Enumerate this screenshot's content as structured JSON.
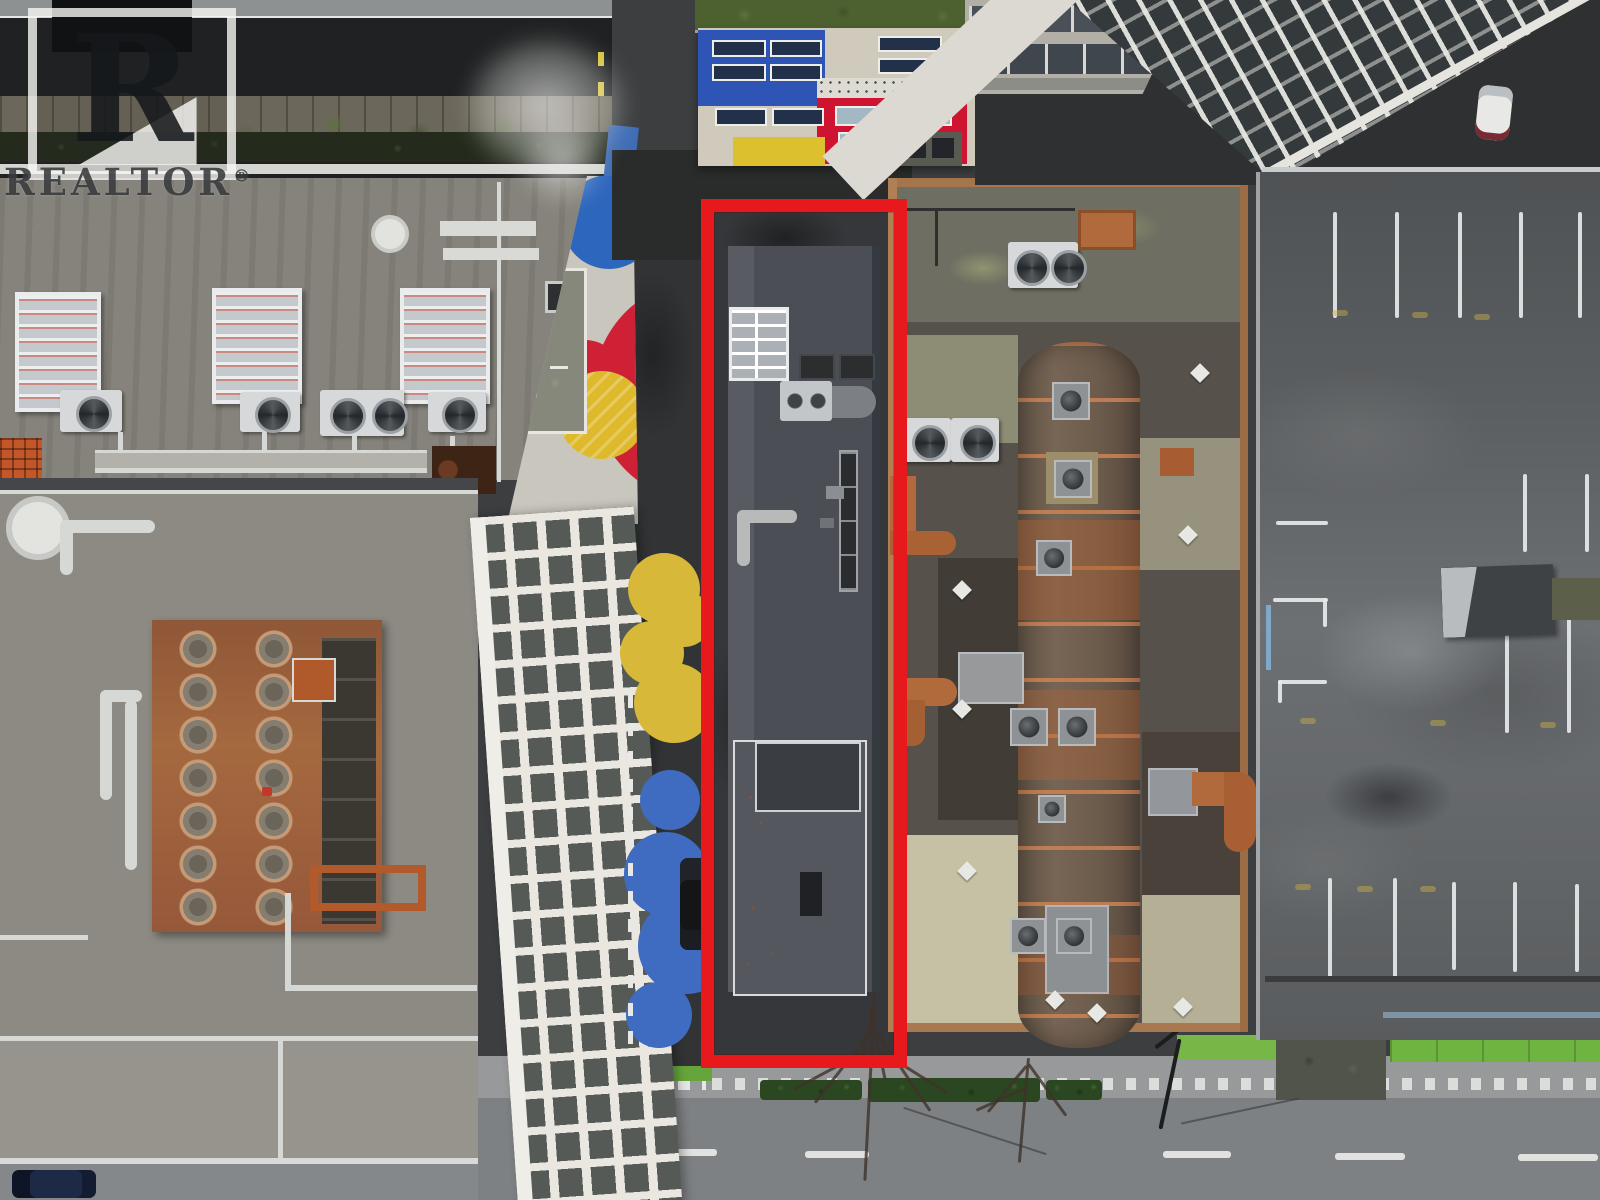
{
  "watermark": {
    "logo_letter": "R",
    "brand": "REALTOR",
    "registered_mark": "®"
  },
  "palette": {
    "highlight-red": "#e8191c",
    "asphalt": "#3c3e40",
    "street": "#7e8184",
    "concrete": "#97999b",
    "roof-gray": "#87857d",
    "roof-dark": "#4b4f55",
    "mondrian-blue": "#2e55b5",
    "mondrian-red": "#ce1430",
    "mondrian-yellow": "#ddc02d",
    "mondrian-cream": "#cfcabc",
    "circle-blue": "#2d66bd",
    "circle-red": "#cf2136",
    "circle-yellow": "#ddb92b",
    "splat-yellow": "#d7b838",
    "splat-blue": "#3f6cc0",
    "bike-green": "#6fb341",
    "green-roof": "#4d6130",
    "copper": "#b06a3c",
    "rust": "#9a5c38",
    "white-paint": "#e9e7e0"
  }
}
